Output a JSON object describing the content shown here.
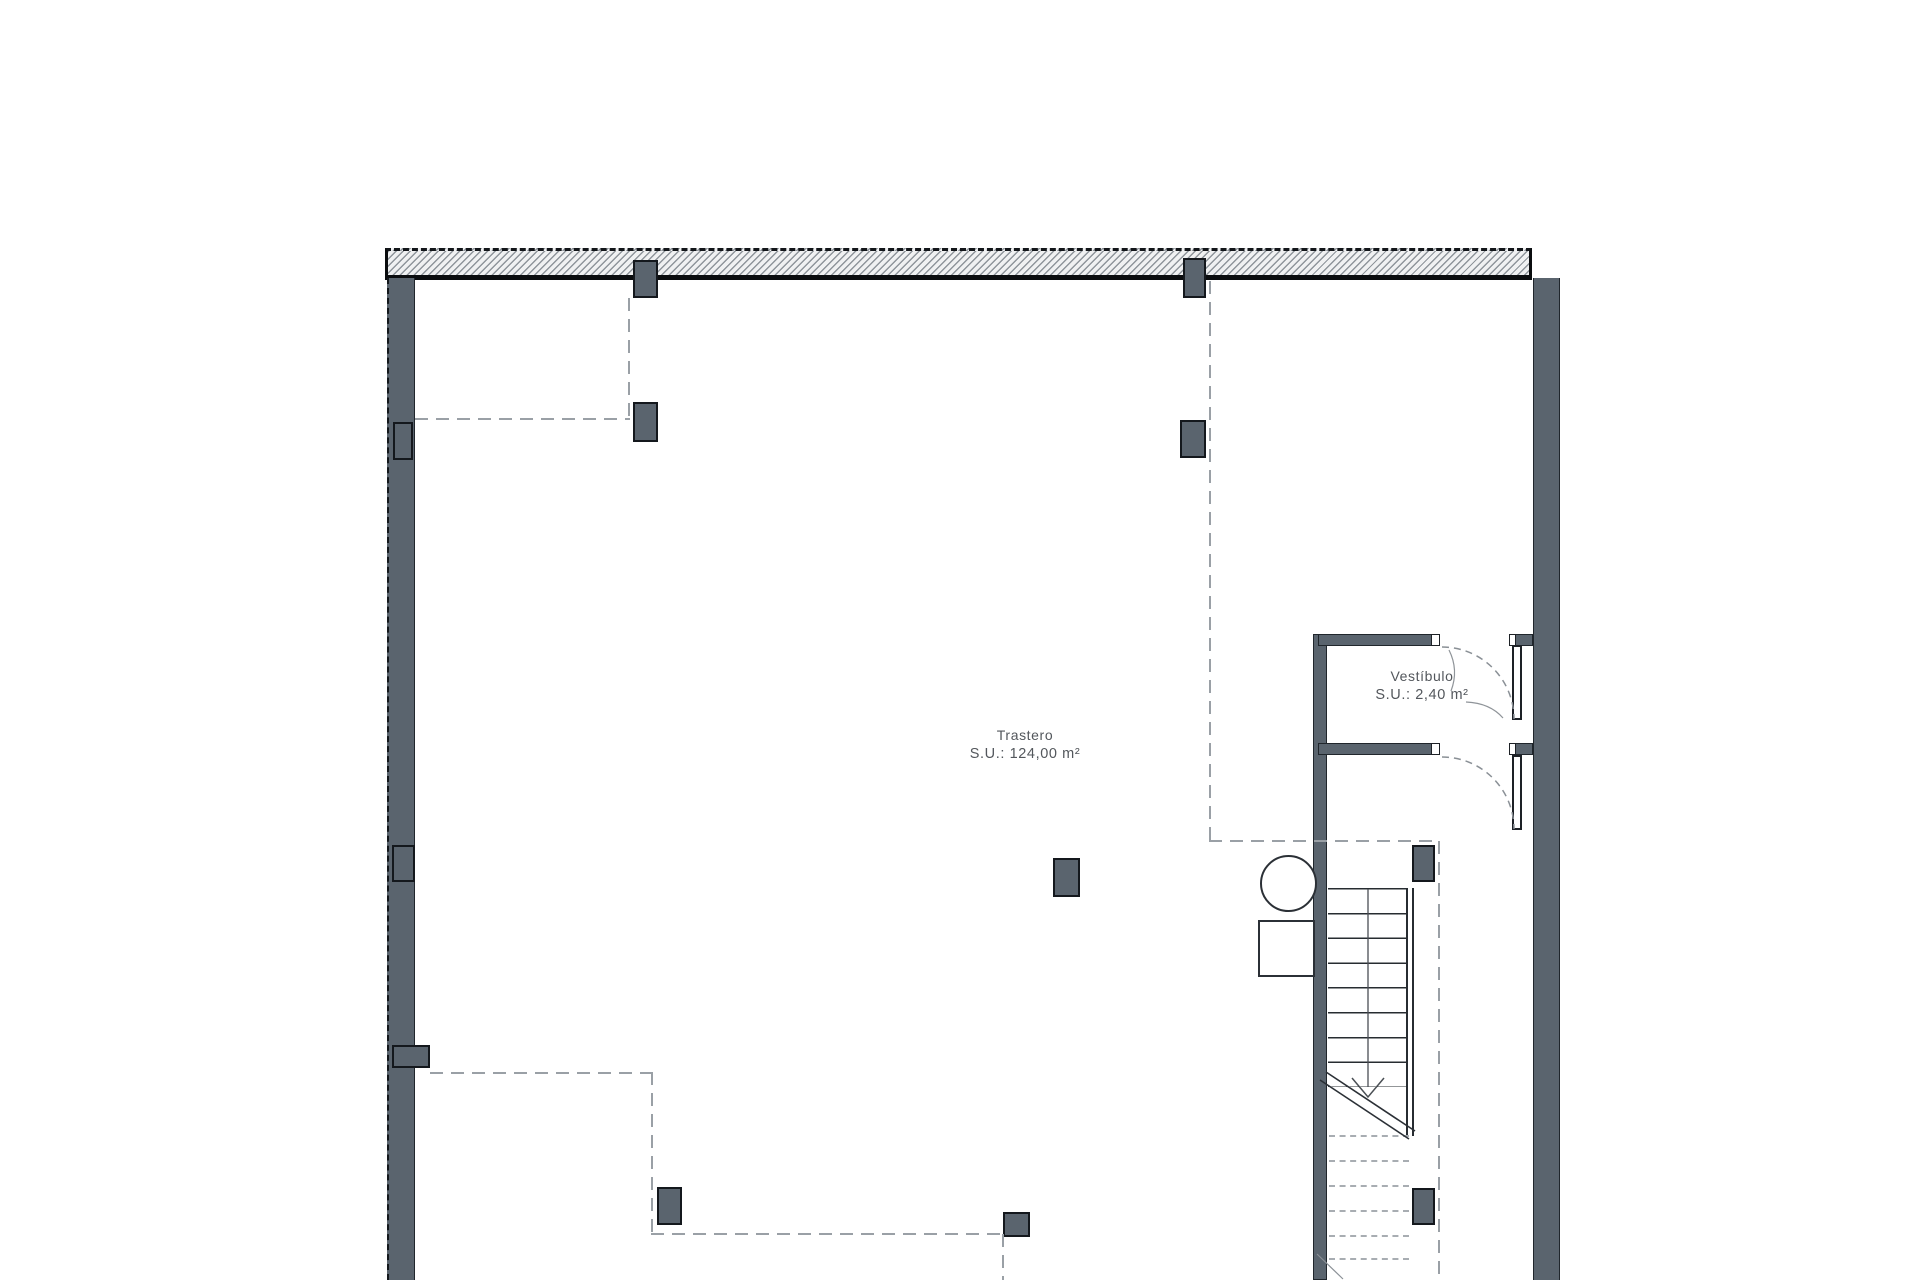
{
  "plan": {
    "title": "Floor plan drawing",
    "rooms": [
      {
        "name": "Trastero",
        "area_label": "S.U.: 124,00 m²"
      },
      {
        "name": "Vestíbulo",
        "area_label": "S.U.: 2,40 m²"
      }
    ],
    "colors": {
      "wall": "#5a646e",
      "wall_outline": "#20262c",
      "line": "#22272c",
      "dash": "#9aa0a6",
      "hatch_line": "#8f959b",
      "hatch_bg": "#f0f1f2",
      "text": "#53575c",
      "background": "#ffffff"
    }
  }
}
